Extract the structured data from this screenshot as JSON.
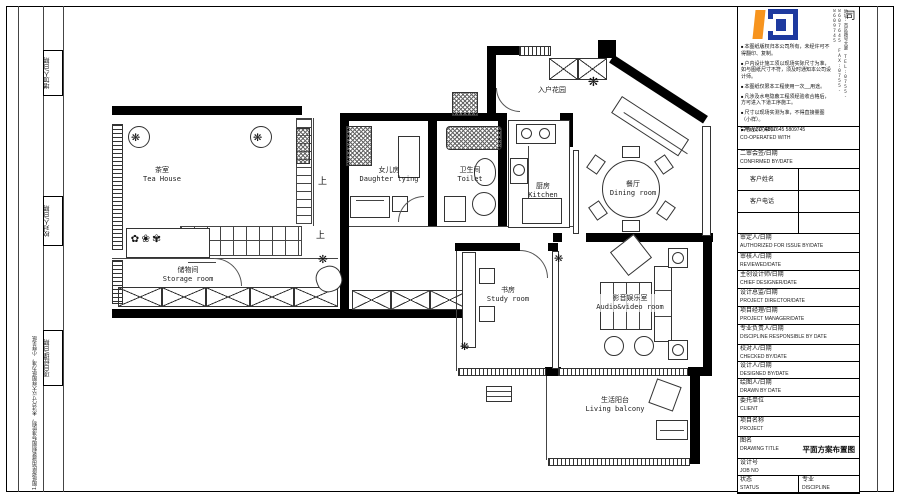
{
  "sheet": {
    "left_margin": {
      "labels": [
        {
          "cn": "增加人/日期",
          "en": "ADDED BY/DATE"
        },
        {
          "cn": "校对人/日期",
          "en": "CHECKED BY/DATE"
        },
        {
          "cn": "项目经理/日期",
          "en": "PROJECT MANAGER/DATE"
        }
      ],
      "note": "1.图纸按民用建筑制图标准绘制，未注尺寸以大样图纸为准，小样见纸"
    }
  },
  "company": {
    "name_vertical": "欧碧雅建筑装饰有限公司",
    "contact_vertical": "地址:市区路号大厦 TEL:0755-8607645 FAX:0755-8609745",
    "logo_colors": {
      "orange": "#F7941E",
      "blue": "#1E3A9F"
    },
    "notes": [
      "本图纸版权归本公司所有，未经许可不得翻印、复制。",
      "户内设计施工须以现场实际尺寸为准，如与图纸尺寸不符，须及时通知本公司设计师。",
      "本图纸仅限本工程使用一次__用途。",
      "凡涉及水电隐蔽工程须经验收合格后，方可进入下道工序施工。",
      "尺寸以现场实测为准，不得直接量图（小样）。",
      "电话 30-)4807645 5809745"
    ]
  },
  "titleblock": {
    "rows": [
      {
        "cn": "合作设计单位",
        "en": "CO-OPERATED WITH"
      },
      {
        "cn": "二审会签/日期",
        "en": "CONFIRMED BY/DATE"
      },
      {
        "cn": "审定人/日期",
        "en": "AUTHORIZED FOR ISSUE BY/DATE"
      },
      {
        "cn": "审核人/日期",
        "en": "REVIEWED/DATE"
      },
      {
        "cn": "主创设计师/日期",
        "en": "CHIEF DESIGNER/DATE"
      },
      {
        "cn": "设计总监/日期",
        "en": "PROJECT DIRECTOR/DATE"
      },
      {
        "cn": "项目经理/日期",
        "en": "PROJECT MANAGER/DATE"
      },
      {
        "cn": "专业负责人/日期",
        "en": "DISCIPLINE RESPONSIBLE BY DATE"
      },
      {
        "cn": "校对人/日期",
        "en": "CHECKED BY/DATE"
      },
      {
        "cn": "设计人/日期",
        "en": "DESIGNED BY/DATE"
      },
      {
        "cn": "绘图人/日期",
        "en": "DRAWN BY DATE"
      },
      {
        "cn": "委托单位",
        "en": "CLIENT"
      },
      {
        "cn": "项目名称",
        "en": "PROJECT"
      },
      {
        "cn": "图名",
        "en": "DRAWING TITLE"
      },
      {
        "cn": "设计号",
        "en": "JOB NO"
      },
      {
        "cn": "状态",
        "en": "STATUS"
      },
      {
        "cn": "专业",
        "en": "DISCIPLINE"
      },
      {
        "cn": "比例",
        "en": "SCALE"
      }
    ],
    "client_fields": [
      {
        "label": "客户姓名"
      },
      {
        "label": "客户电话"
      },
      {
        "label": ""
      }
    ],
    "drawing_title_value": "平面方案布置图"
  },
  "plan": {
    "rooms": [
      {
        "cn": "茶室",
        "en": "Tea House"
      },
      {
        "cn": "女儿房",
        "en": "Daughter lying"
      },
      {
        "cn": "卫生间",
        "en": "Toilet"
      },
      {
        "cn": "厨房",
        "en": "Kitchen"
      },
      {
        "cn": "入户花园",
        "en": ""
      },
      {
        "cn": "餐厅",
        "en": "Dining room"
      },
      {
        "cn": "储物间",
        "en": "Storage room"
      },
      {
        "cn": "书房",
        "en": "Study room"
      },
      {
        "cn": "影音娱乐室",
        "en": "Audio&video room"
      },
      {
        "cn": "生活阳台",
        "en": "Living balcony"
      }
    ],
    "stair_up_label": "上"
  }
}
